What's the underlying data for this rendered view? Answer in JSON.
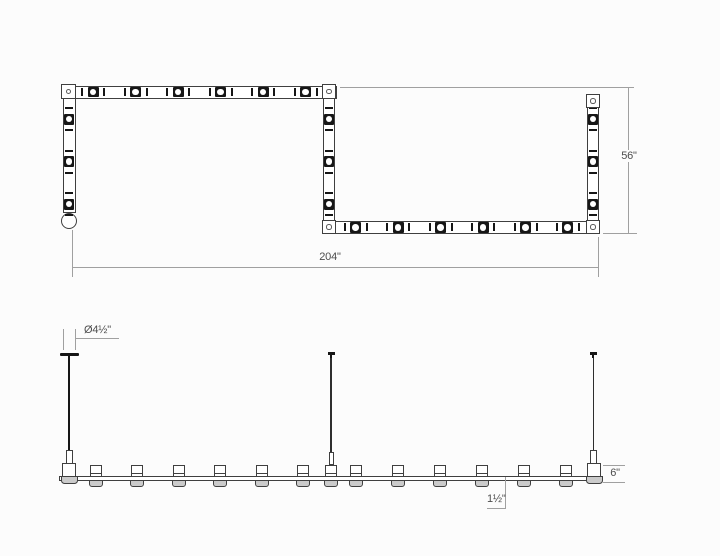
{
  "colors": {
    "line": "#3f3f3f",
    "ink": "#161616",
    "dim": "#a0a0a0",
    "text": "#4d4d4d",
    "fill": "#cbcbcb",
    "bg": "#fcfcfc"
  },
  "plan": {
    "dims": {
      "width": "204\"",
      "height": "56\""
    },
    "top_run_modules_x": [
      93,
      135.5,
      178,
      220.5,
      263,
      305.5
    ],
    "bottom_run_modules_x": [
      355.5,
      398,
      440.5,
      483,
      525.5,
      567.5
    ],
    "left_run_modules_y": [
      119,
      161.5,
      204
    ],
    "mid_run_modules_y": [
      119,
      161.5,
      204
    ],
    "right_run_modules_y": [
      119,
      161.5,
      204
    ],
    "left_run_x": 69,
    "mid_run_x": 329,
    "right_run_x": 593,
    "plates": [
      [
        61,
        84
      ],
      [
        321.5,
        84
      ],
      [
        321.5,
        219.5
      ],
      [
        585.5,
        93.5
      ],
      [
        585.5,
        219.5
      ]
    ]
  },
  "elevation": {
    "dims": {
      "canopy_diameter": "Ø4½\"",
      "end_height": "6\"",
      "lens_drop": "1½\""
    },
    "modules_x": [
      95.5,
      137,
      178.5,
      220,
      261.5,
      303,
      356,
      398,
      440,
      482,
      524,
      566
    ],
    "mid_module_x": 330.5
  }
}
